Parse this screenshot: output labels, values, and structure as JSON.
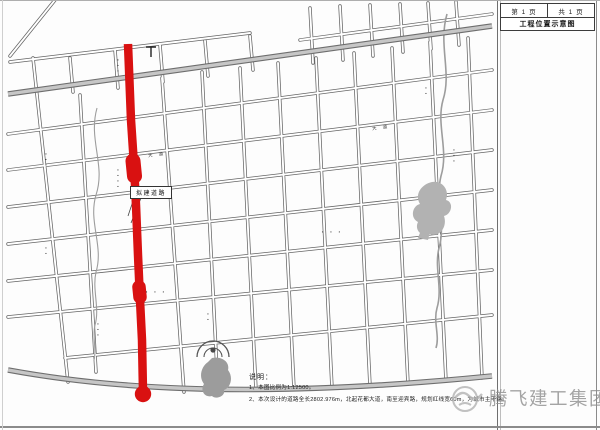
{
  "title_block": {
    "page": "第 1 页",
    "total": "共 1 页",
    "title": "工程位置示意图"
  },
  "map": {
    "road_label": "拟建道路",
    "street_names": [
      "大 道",
      "大 道"
    ],
    "micro_labels": [
      "▪▪▪",
      "▪▪▪▪",
      "▪▪▪",
      "▪▪",
      "▪ ▪ ▪",
      "▪ ▪ ▪",
      "▪▪▪",
      "▪▪",
      "▪▪",
      "▪▪▪"
    ],
    "notes": {
      "heading": "说明：",
      "item1": "1、本图比例为1:12500。",
      "item2": "2、本次设计的道路全长2802.976m，北起花都大道，南至迎宾路，规划红线宽60m，为城市主干路。"
    },
    "colors": {
      "highlight_road": "#d91111",
      "street_line": "#606060",
      "major_road_fill": "#c6c6c6",
      "park_fill": "#b2b2b2"
    }
  },
  "watermark": {
    "text": "腾飞建工集团"
  }
}
